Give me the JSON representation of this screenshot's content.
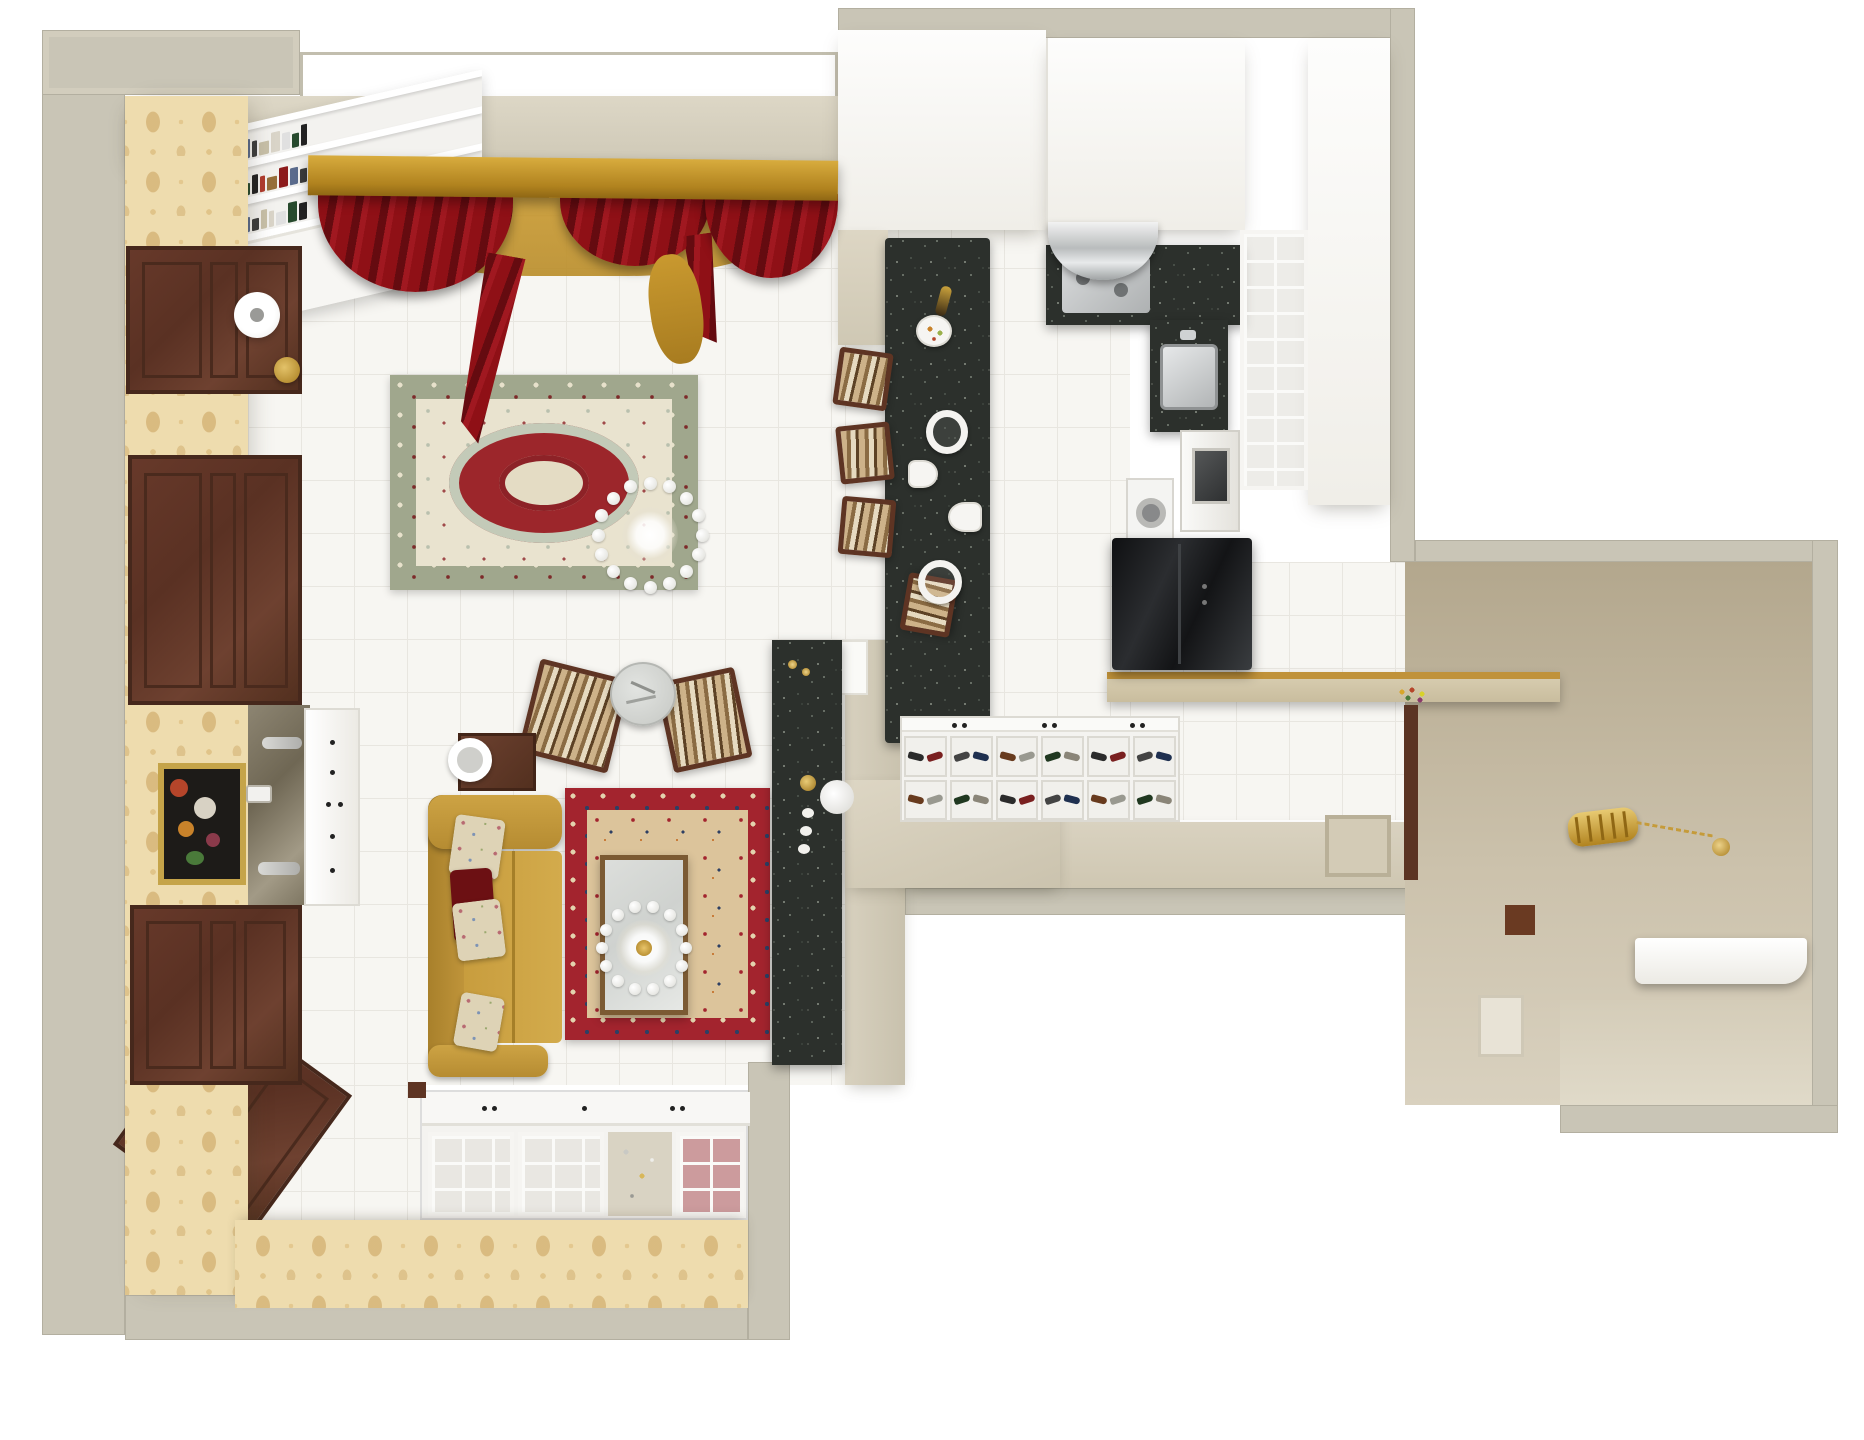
{
  "scene": {
    "title": "Top-down 3D render of a classic apartment interior",
    "view": "bird's-eye perspective",
    "rooms_count": 3
  },
  "rooms": {
    "living": {
      "label": "Living room"
    },
    "kitchen": {
      "label": "Kitchen"
    },
    "hallway": {
      "label": "Entry hallway"
    }
  },
  "labels": {
    "wallpaper": "Beige damask wallpaper wall",
    "door_panel": "Dark wood door panel",
    "bookshelf": "White bookshelf with books",
    "window": "Window",
    "pelmet": "Gold curtain pelmet",
    "curtains": "Dark red swag curtains",
    "floor_lamp": "Floor lamp",
    "rug_main": "Cream persian rug",
    "chandelier": "Crystal chandelier",
    "round_table": "Round glass table",
    "armchair": "Striped armchair",
    "side_table": "Wood side table with lamp",
    "sofa": "Mustard sofa with pillows",
    "rug_red": "Red persian rug",
    "coffee_table": "Glass coffee table",
    "media_wall": "Black granite media wall",
    "painting": "Framed floral painting",
    "sideboard": "White sideboard",
    "sconce": "Wall sconce",
    "clock": "Wall clock",
    "china_cabinet": "White display cabinets",
    "parquet_door": "Wood doorway",
    "bar": "Granite breakfast bar",
    "bar_stool": "Woven bar stool",
    "pendant": "Pendant light",
    "fruit_plate": "Plate with fruit",
    "wine_bottle": "Wine bottle",
    "hood": "Stainless range hood",
    "cooktop": "Cooktop on granite counter",
    "sink": "Kitchen sink",
    "washer": "Washing machine",
    "oven": "Built-in oven",
    "fridge": "Black refrigerator",
    "upper_cabinets": "White upper cabinets",
    "glass_cabinet": "Glass-front cabinet",
    "console": "Hall console with gold edge",
    "flowers": "Flower decor",
    "shoe_cabinet": "Open shoe cabinet",
    "lantern": "Gold lantern pendant",
    "bench": "White entry bench",
    "square_seat": "Hall seat frame",
    "partition": "Beige partition wall",
    "outer_wall": "Outer wall"
  },
  "palette": {
    "outer_wall": "#c9c5b6",
    "soffit": "#d8d2c1",
    "wallpaper": "#eedcae",
    "wallpaper_motif": "#c9a05c",
    "wood_door": "#5e3423",
    "gold": "#c59b3a",
    "curtain_red": "#8f1016",
    "tile": "#f7f6f2",
    "rug_border_sage": "#a0a78d",
    "rug_field_cream": "#e9e3cf",
    "rug_red": "#a3242e",
    "rug_navy": "#2e3f63",
    "sofa_mustard": "#c89d3e",
    "granite": "#2c302c",
    "fridge_black": "#17181a",
    "entry_taupe": "#c3b69e"
  },
  "counts": {
    "door_panels": 3,
    "armchairs": 2,
    "bar_stools": 4,
    "rugs": 2,
    "chandeliers": 2,
    "curtain_swags": 3,
    "shoe_compartments": 12,
    "pendant_lights": 2
  },
  "decor": {
    "book_spine_colors": [
      "#8c1a1a",
      "#222222",
      "#d9d4c8",
      "#5a6b8c",
      "#b03c2e",
      "#e0e0e0",
      "#3d3d3d",
      "#97703a",
      "#274a2d",
      "#c8c0a8"
    ],
    "shoe_colors": [
      "#2b2b2b",
      "#7a2020",
      "#444444",
      "#1f3050",
      "#683b1e",
      "#999990",
      "#203820",
      "#8a8578"
    ],
    "chandelier1_bulbs": 16,
    "chandelier2_bulbs": 14,
    "sparkle_color": "#ffffff"
  }
}
